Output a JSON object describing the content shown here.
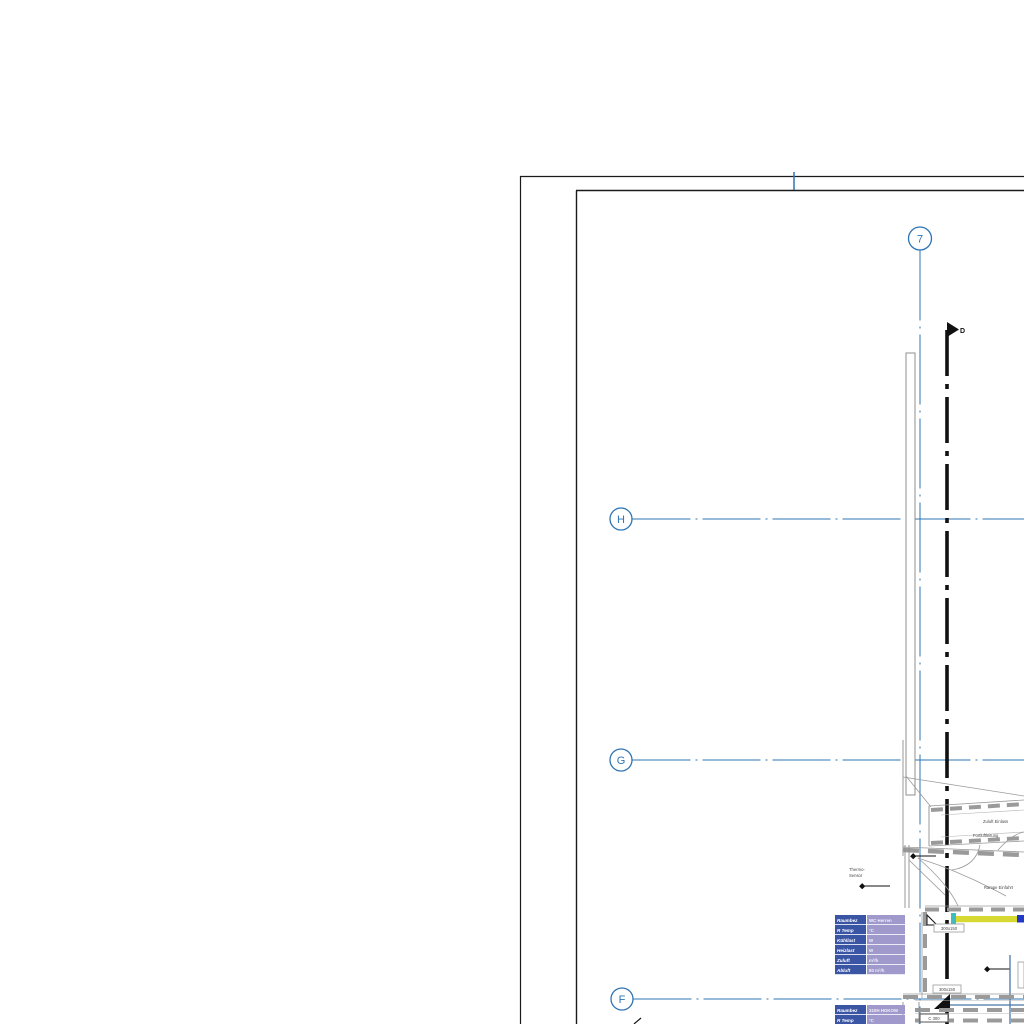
{
  "colors": {
    "grid_blue": "#2e74b5",
    "line_black": "#1a1a1a",
    "line_gray": "#8f8f8f",
    "tag_label_bg": "#3b55a5",
    "tag_value_bg": "#9f99cc",
    "duct_yellow": "#d8d832",
    "duct_cyan": "#3fbcbc",
    "duct_blue": "#2438c8",
    "pipe_blue": "#4878a8"
  },
  "grid": {
    "column_bubbles": [
      {
        "label": "7"
      }
    ],
    "row_bubbles": [
      {
        "label": "H"
      },
      {
        "label": "G"
      },
      {
        "label": "F"
      }
    ]
  },
  "section_marker": {
    "label": "D"
  },
  "annotations": {
    "duct_note_line1": "Zuluft Einlass",
    "duct_note_line2": "Fortluftleitung",
    "ramp_note": "Rampe Einfahrt",
    "sensor_note_line1": "Thermo-",
    "sensor_note_line2": "Sensor",
    "duct_size_label_1": "300x150",
    "duct_size_label_2": "300x150",
    "duct_size_label_3": "C 300"
  },
  "space_tags": [
    {
      "rows": [
        {
          "label": "Raumbez",
          "value": "WC Herren"
        },
        {
          "label": "R Temp",
          "value": "°C"
        },
        {
          "label": "Kühllast",
          "value": "W"
        },
        {
          "label": "Heizlast",
          "value": "W"
        },
        {
          "label": "Zuluft",
          "value": "m³/h"
        },
        {
          "label": "Abluft",
          "value": "80 m³/h"
        }
      ]
    },
    {
      "rows": [
        {
          "label": "Raumbez",
          "value": "310H HOKOW"
        },
        {
          "label": "R Temp",
          "value": "°C"
        }
      ]
    }
  ]
}
